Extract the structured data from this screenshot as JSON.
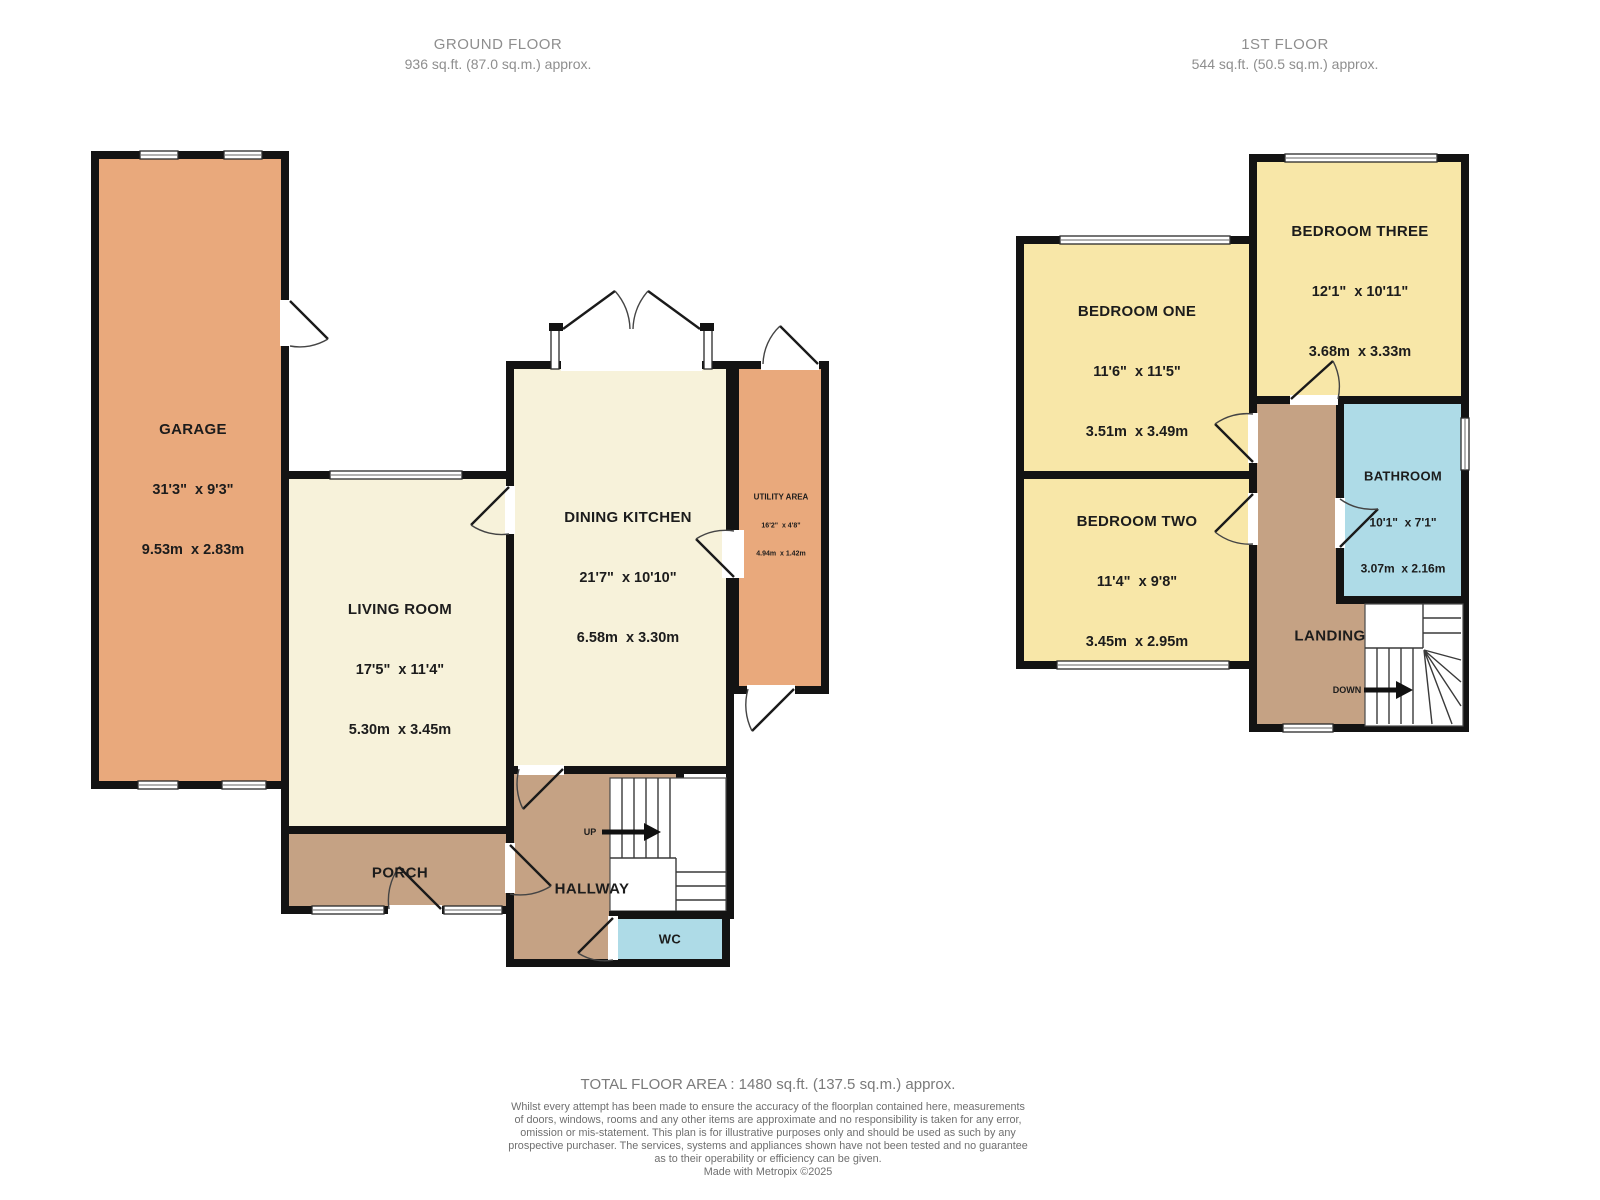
{
  "headers": {
    "ground": {
      "title": "GROUND FLOOR",
      "area": "936 sq.ft. (87.0 sq.m.) approx."
    },
    "first": {
      "title": "1ST FLOOR",
      "area": "544 sq.ft. (50.5 sq.m.) approx."
    }
  },
  "ground_floor": {
    "garage": {
      "name": "GARAGE",
      "imperial": "31'3\"  x 9'3\"",
      "metric": "9.53m  x 2.83m"
    },
    "living_room": {
      "name": "LIVING ROOM",
      "imperial": "17'5\"  x 11'4\"",
      "metric": "5.30m  x 3.45m"
    },
    "dining_kitchen": {
      "name": "DINING KITCHEN",
      "imperial": "21'7\"  x 10'10\"",
      "metric": "6.58m  x 3.30m"
    },
    "utility_area": {
      "name": "UTILITY AREA",
      "imperial": "16'2\"  x 4'8\"",
      "metric": "4.94m  x 1.42m"
    },
    "porch": {
      "name": "PORCH"
    },
    "hallway": {
      "name": "HALLWAY"
    },
    "wc": {
      "name": "WC"
    },
    "stairs_up": "UP"
  },
  "first_floor": {
    "bedroom_one": {
      "name": "BEDROOM ONE",
      "imperial": "11'6\"  x 11'5\"",
      "metric": "3.51m  x 3.49m"
    },
    "bedroom_two": {
      "name": "BEDROOM TWO",
      "imperial": "11'4\"  x 9'8\"",
      "metric": "3.45m  x 2.95m"
    },
    "bedroom_three": {
      "name": "BEDROOM THREE",
      "imperial": "12'1\"  x 10'11\"",
      "metric": "3.68m  x 3.33m"
    },
    "bathroom": {
      "name": "BATHROOM",
      "imperial": "10'1\"  x 7'1\"",
      "metric": "3.07m  x 2.16m"
    },
    "landing": {
      "name": "LANDING"
    },
    "stairs_down": "DOWN"
  },
  "footer": {
    "total": "TOTAL FLOOR AREA : 1480 sq.ft. (137.5 sq.m.) approx.",
    "disclaimer_lines": [
      "Whilst every attempt has been made to ensure the accuracy of the floorplan contained here, measurements",
      "of doors, windows, rooms and any other items are approximate and no responsibility is taken for any error,",
      "omission or mis-statement. This plan is for illustrative purposes only and should be used as such by any",
      "prospective purchaser. The services, systems and appliances shown have not been tested and no guarantee",
      "as to their operability or efficiency can be given."
    ],
    "credit": "Made with Metropix ©2025"
  },
  "colors": {
    "garage_utility_fill": "#e9a97c",
    "living_kitchen_fill": "#f7f2da",
    "bedroom_fill": "#f8e7a8",
    "hall_landing_fill": "#c5a284",
    "wet_room_fill": "#aedbe7",
    "wall": "#131313",
    "header_text": "#8e8e8e",
    "footer_text": "#6f6f6f",
    "label_text": "#1c1c1c"
  }
}
